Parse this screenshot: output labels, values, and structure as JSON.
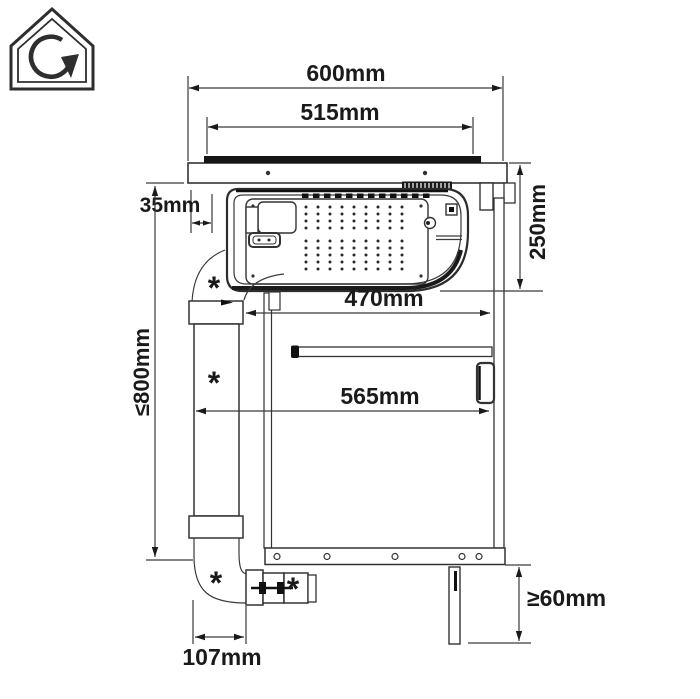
{
  "diagram": {
    "kind": "hob-downdraft-installation-drawing",
    "icon": "recirculation-house",
    "labels": {
      "total_width": "600mm",
      "cutout_width": "515mm",
      "left_clearance": "35mm",
      "unit_depth": "250mm",
      "clearance_upper": "470mm",
      "clearance_lower": "565mm",
      "max_height": "≤800mm",
      "duct_offset": "107mm",
      "plinth_height": "≥60mm",
      "accessory_marker": "*"
    },
    "colors": {
      "line": "#333333",
      "dark_fill": "#1a1a1a",
      "background": "#ffffff"
    }
  }
}
